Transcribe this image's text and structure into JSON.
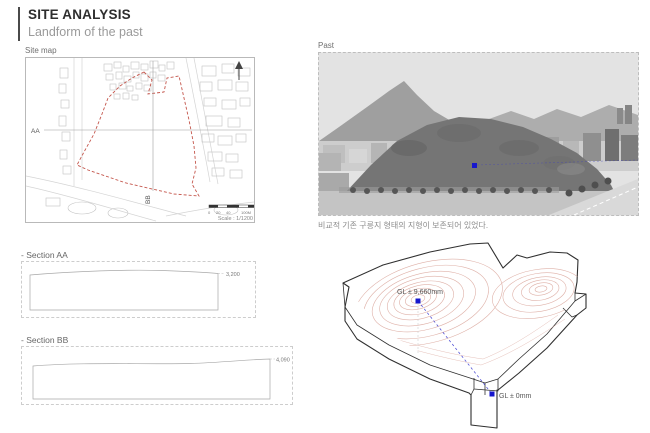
{
  "header": {
    "title": "SITE ANALYSIS",
    "subtitle": "Landform of the past"
  },
  "site_map": {
    "label": "Site map",
    "section_aa_label": "AA",
    "section_bb_label": "BB",
    "scale_ticks": [
      "0",
      "20",
      "40",
      "100M"
    ],
    "scale_text": "Scale : 1/1200",
    "boundary_color": "#c4564c"
  },
  "past": {
    "label": "Past",
    "caption": "비교적 기존 구릉지 형태의 지형이 보존되어 있었다.",
    "marker_color": "#1616cd"
  },
  "sections": [
    {
      "label": "- Section AA",
      "height_label": "3,200"
    },
    {
      "label": "- Section BB",
      "height_label": "4,090"
    }
  ],
  "terrain_model": {
    "peak_label": "GL ± 9,660mm",
    "base_label": "GL ± 0mm",
    "marker_color": "#1616cd",
    "contour_color": "#dba89e"
  }
}
